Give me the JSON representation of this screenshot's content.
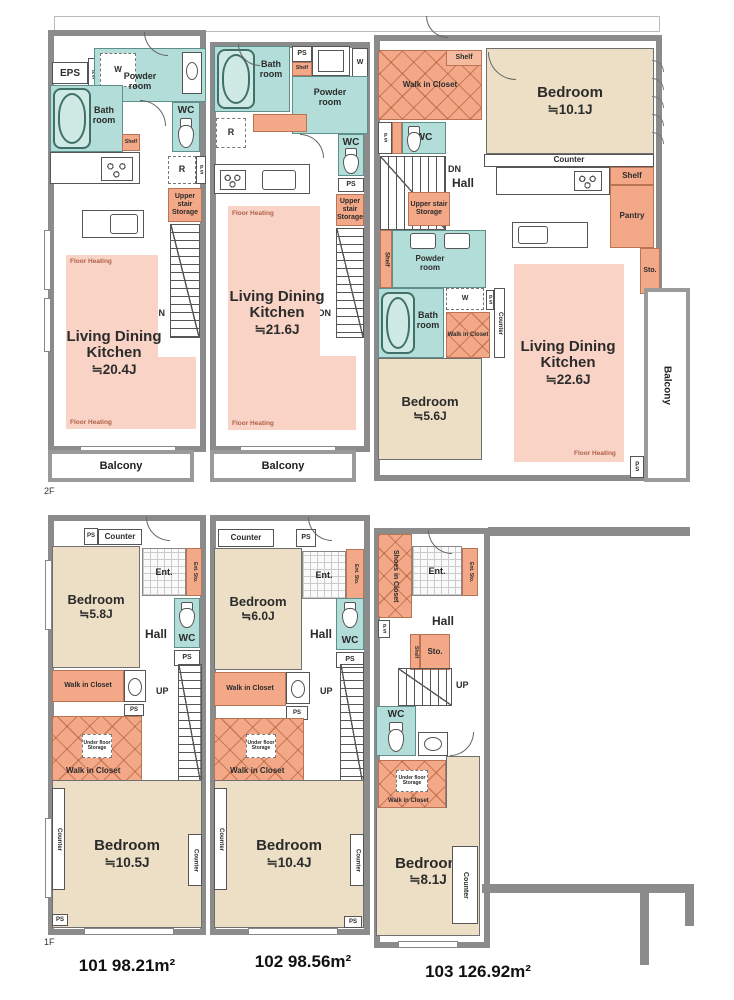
{
  "t": {
    "eps": "EPS",
    "ps": "PS",
    "w": "W",
    "r": "R",
    "wc": "WC",
    "bath": "Bath room",
    "powder": "Powder room",
    "shelf": "Shelf",
    "uss": "Upper stair Storage",
    "unders": "Under stair Storage",
    "ufs": "Under floor Storage",
    "wic": "Walk in Closet",
    "sic": "Shoes in Closet",
    "ent": "Ent.",
    "entsto": "Ent. Sto.",
    "sto": "Sto.",
    "hall": "Hall",
    "counter": "Counter",
    "pantry": "Pantry",
    "balcony": "Balcony",
    "dn": "DN",
    "up": "UP",
    "fh": "Floor Heating",
    "ldk": "Living Dining Kitchen",
    "bedroom": "Bedroom"
  },
  "floors": {
    "f2": "2F",
    "f1": "1F"
  },
  "sizes": {
    "f2_u101_ldk": "≒20.4J",
    "f2_u102_ldk": "≒21.6J",
    "f2_u103_ldk": "≒22.6J",
    "f2_u103_bed1": "≒10.1J",
    "f2_u103_bed2": "≒5.6J",
    "f1_u101_bed1": "≒5.8J",
    "f1_u101_bed2": "≒10.5J",
    "f1_u102_bed1": "≒6.0J",
    "f1_u102_bed2": "≒10.4J",
    "f1_u103_bed1": "≒8.1J"
  },
  "areas": {
    "u101": "101 98.21m²",
    "u102": "102 98.56m²",
    "u103": "103 126.92m²"
  },
  "colors": {
    "wet_area": "#b2ddd8",
    "storage": "#f3a888",
    "bedroom": "#ecdfc5",
    "floor_heating": "#f9d3c5",
    "wall": "#8b8b8b"
  }
}
